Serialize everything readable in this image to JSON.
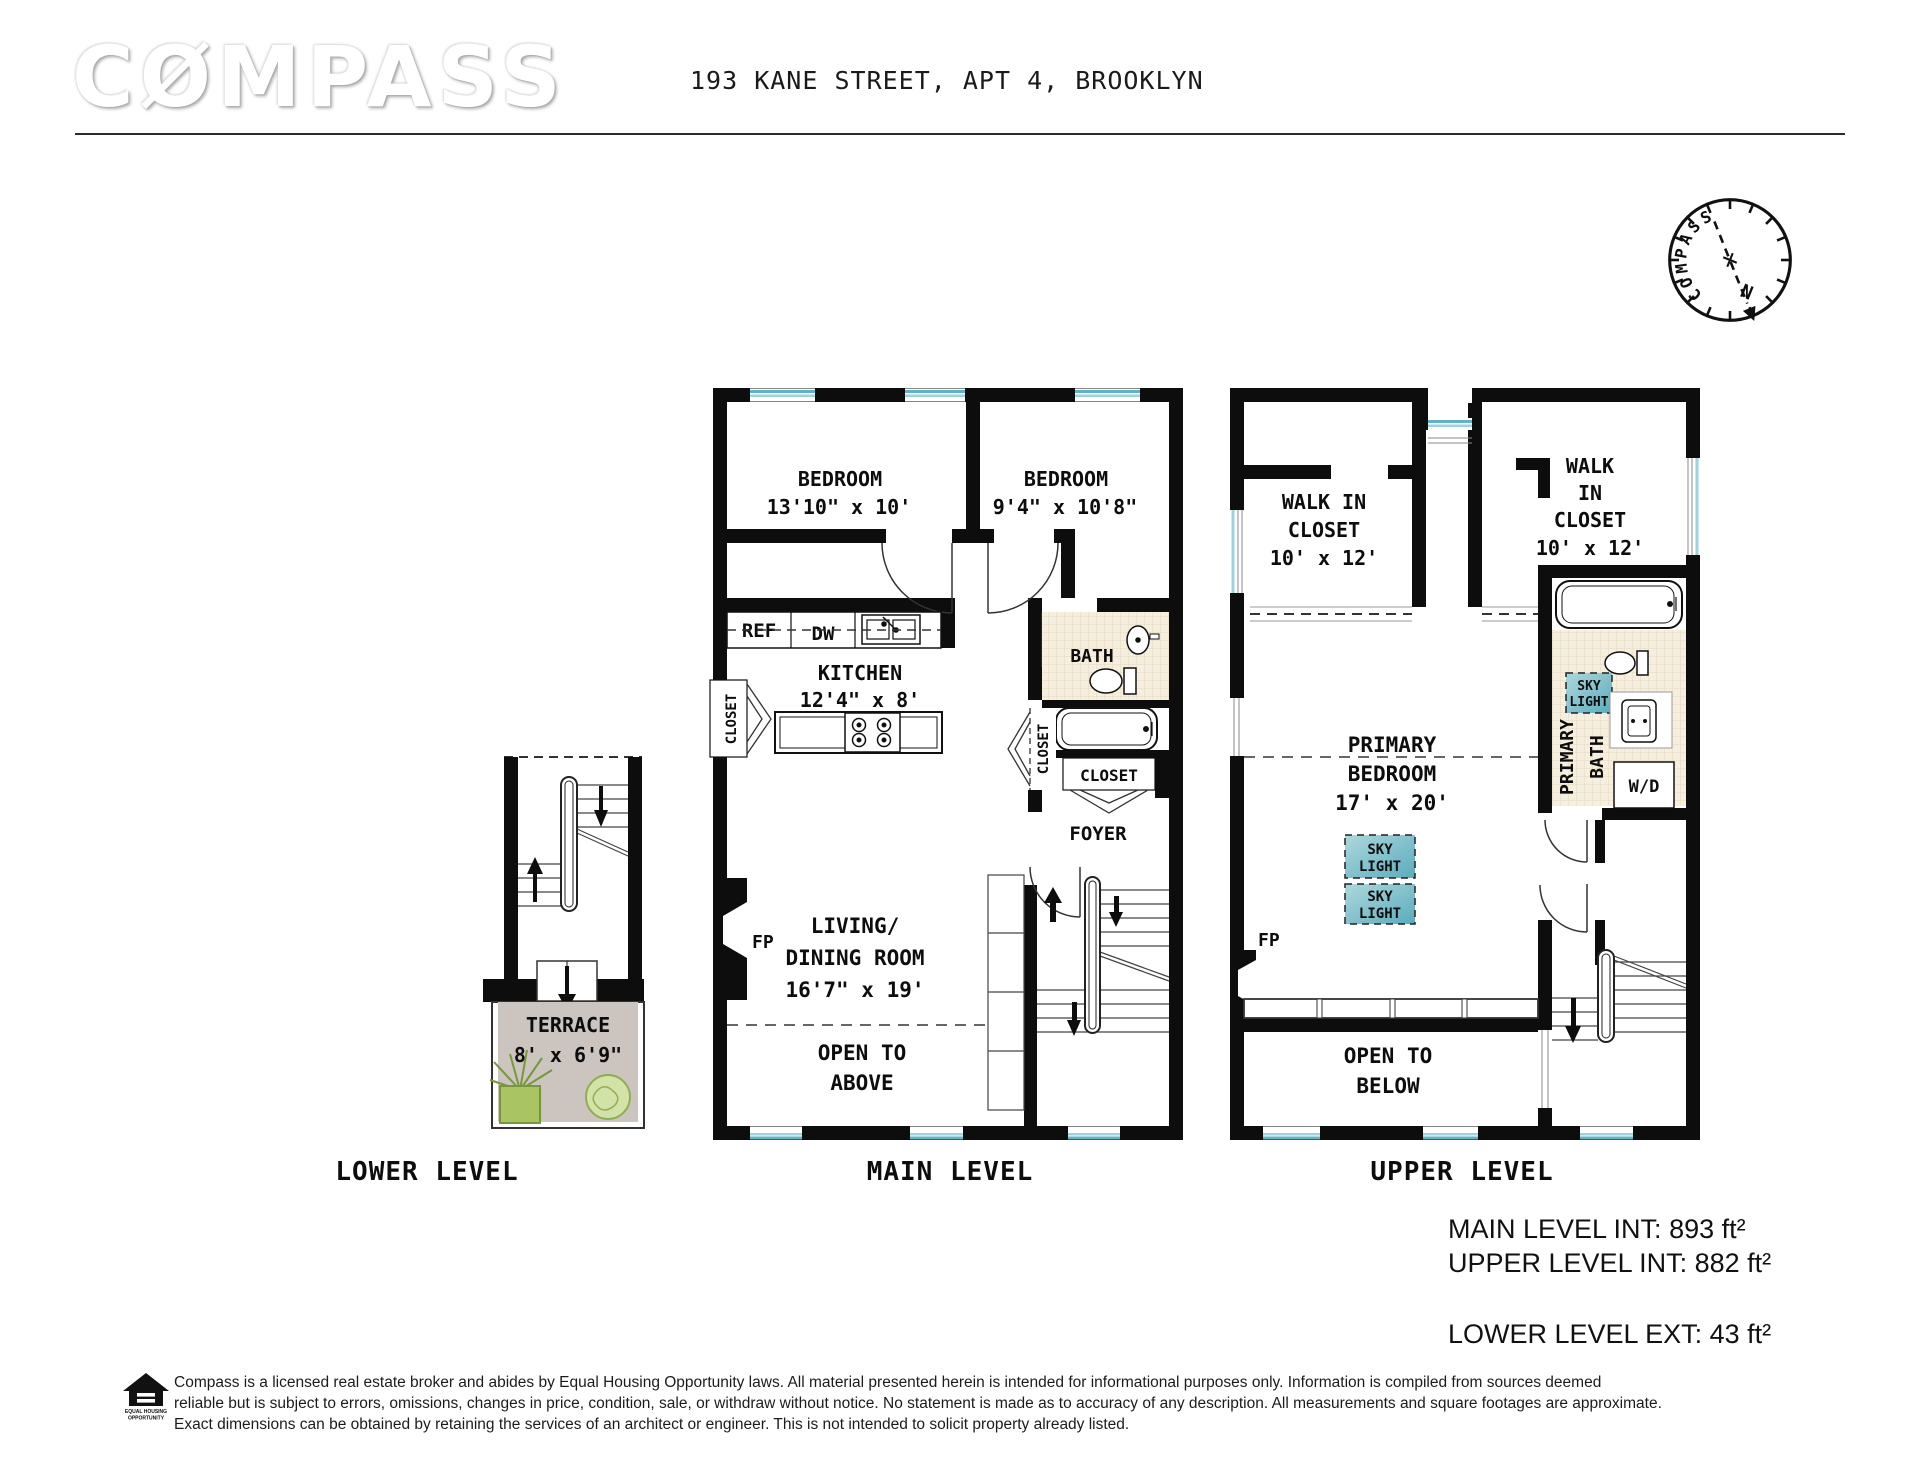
{
  "header": {
    "logo": "CØMPASS",
    "address": "193 KANE STREET, APT 4, BROOKLYN"
  },
  "compass": {
    "label": "COMPASS",
    "north": "N"
  },
  "lower": {
    "label": "LOWER LEVEL",
    "terrace_name": "TERRACE",
    "terrace_dims": "8' x 6'9\""
  },
  "main": {
    "label": "MAIN LEVEL",
    "bedroom1_name": "BEDROOM",
    "bedroom1_dims": "13'10\" x 10'",
    "bedroom2_name": "BEDROOM",
    "bedroom2_dims": "9'4\" x 10'8\"",
    "kitchen_name": "KITCHEN",
    "kitchen_dims": "12'4\" x 8'",
    "ref": "REF",
    "dw": "DW",
    "bath": "BATH",
    "closet_left": "CLOSET",
    "closet_hall": "CLOSET",
    "closet_foyer": "CLOSET",
    "foyer": "FOYER",
    "fp": "FP",
    "living1": "LIVING/",
    "living2": "DINING ROOM",
    "living_dims": "16'7\" x 19'",
    "open1": "OPEN TO",
    "open2": "ABOVE"
  },
  "upper": {
    "label": "UPPER LEVEL",
    "wic1_line1": "WALK IN",
    "wic1_line2": "CLOSET",
    "wic1_dims": "10' x 12'",
    "wic2_line1": "WALK",
    "wic2_line2": "IN",
    "wic2_line3": "CLOSET",
    "wic2_dims": "10' x 12'",
    "pb1": "PRIMARY",
    "pb2": "BEDROOM",
    "pb_dims": "17' x 20'",
    "pbath1": "PRIMARY",
    "pbath2": "BATH",
    "wd": "W/D",
    "fp": "FP",
    "sky1": "SKY",
    "sky2": "LIGHT",
    "open1": "OPEN TO",
    "open2": "BELOW"
  },
  "areas": {
    "main": "MAIN LEVEL INT: 893 ft²",
    "upper": "UPPER LEVEL INT: 882 ft²",
    "lower": "LOWER LEVEL EXT: 43 ft²"
  },
  "footer": {
    "eho1": "EQUAL HOUSING",
    "eho2": "OPPORTUNITY",
    "line1": "Compass is a licensed real estate broker and abides by Equal Housing Opportunity laws. All material presented herein is intended for informational purposes only. Information is compiled from sources deemed",
    "line2": "reliable but is subject to errors, omissions, changes in price, condition, sale, or withdraw without notice. No statement is made as to accuracy of any description. All measurements and square footages are approximate.",
    "line3": "Exact dimensions can be obtained by retaining the services of an architect or engineer. This is not intended to solicit property already listed."
  },
  "colors": {
    "wall": "#0d0d0d",
    "window_glass_dark": "#5fb3c4",
    "window_glass_light": "#9ed2dd",
    "skylight_dark": "#5aacbd",
    "skylight_light": "#aed8dd",
    "bath_tile": "#f6efdf",
    "terrace_floor": "#ccc5bf",
    "plant_green": "#a8c463",
    "north_red": "#c32222"
  }
}
